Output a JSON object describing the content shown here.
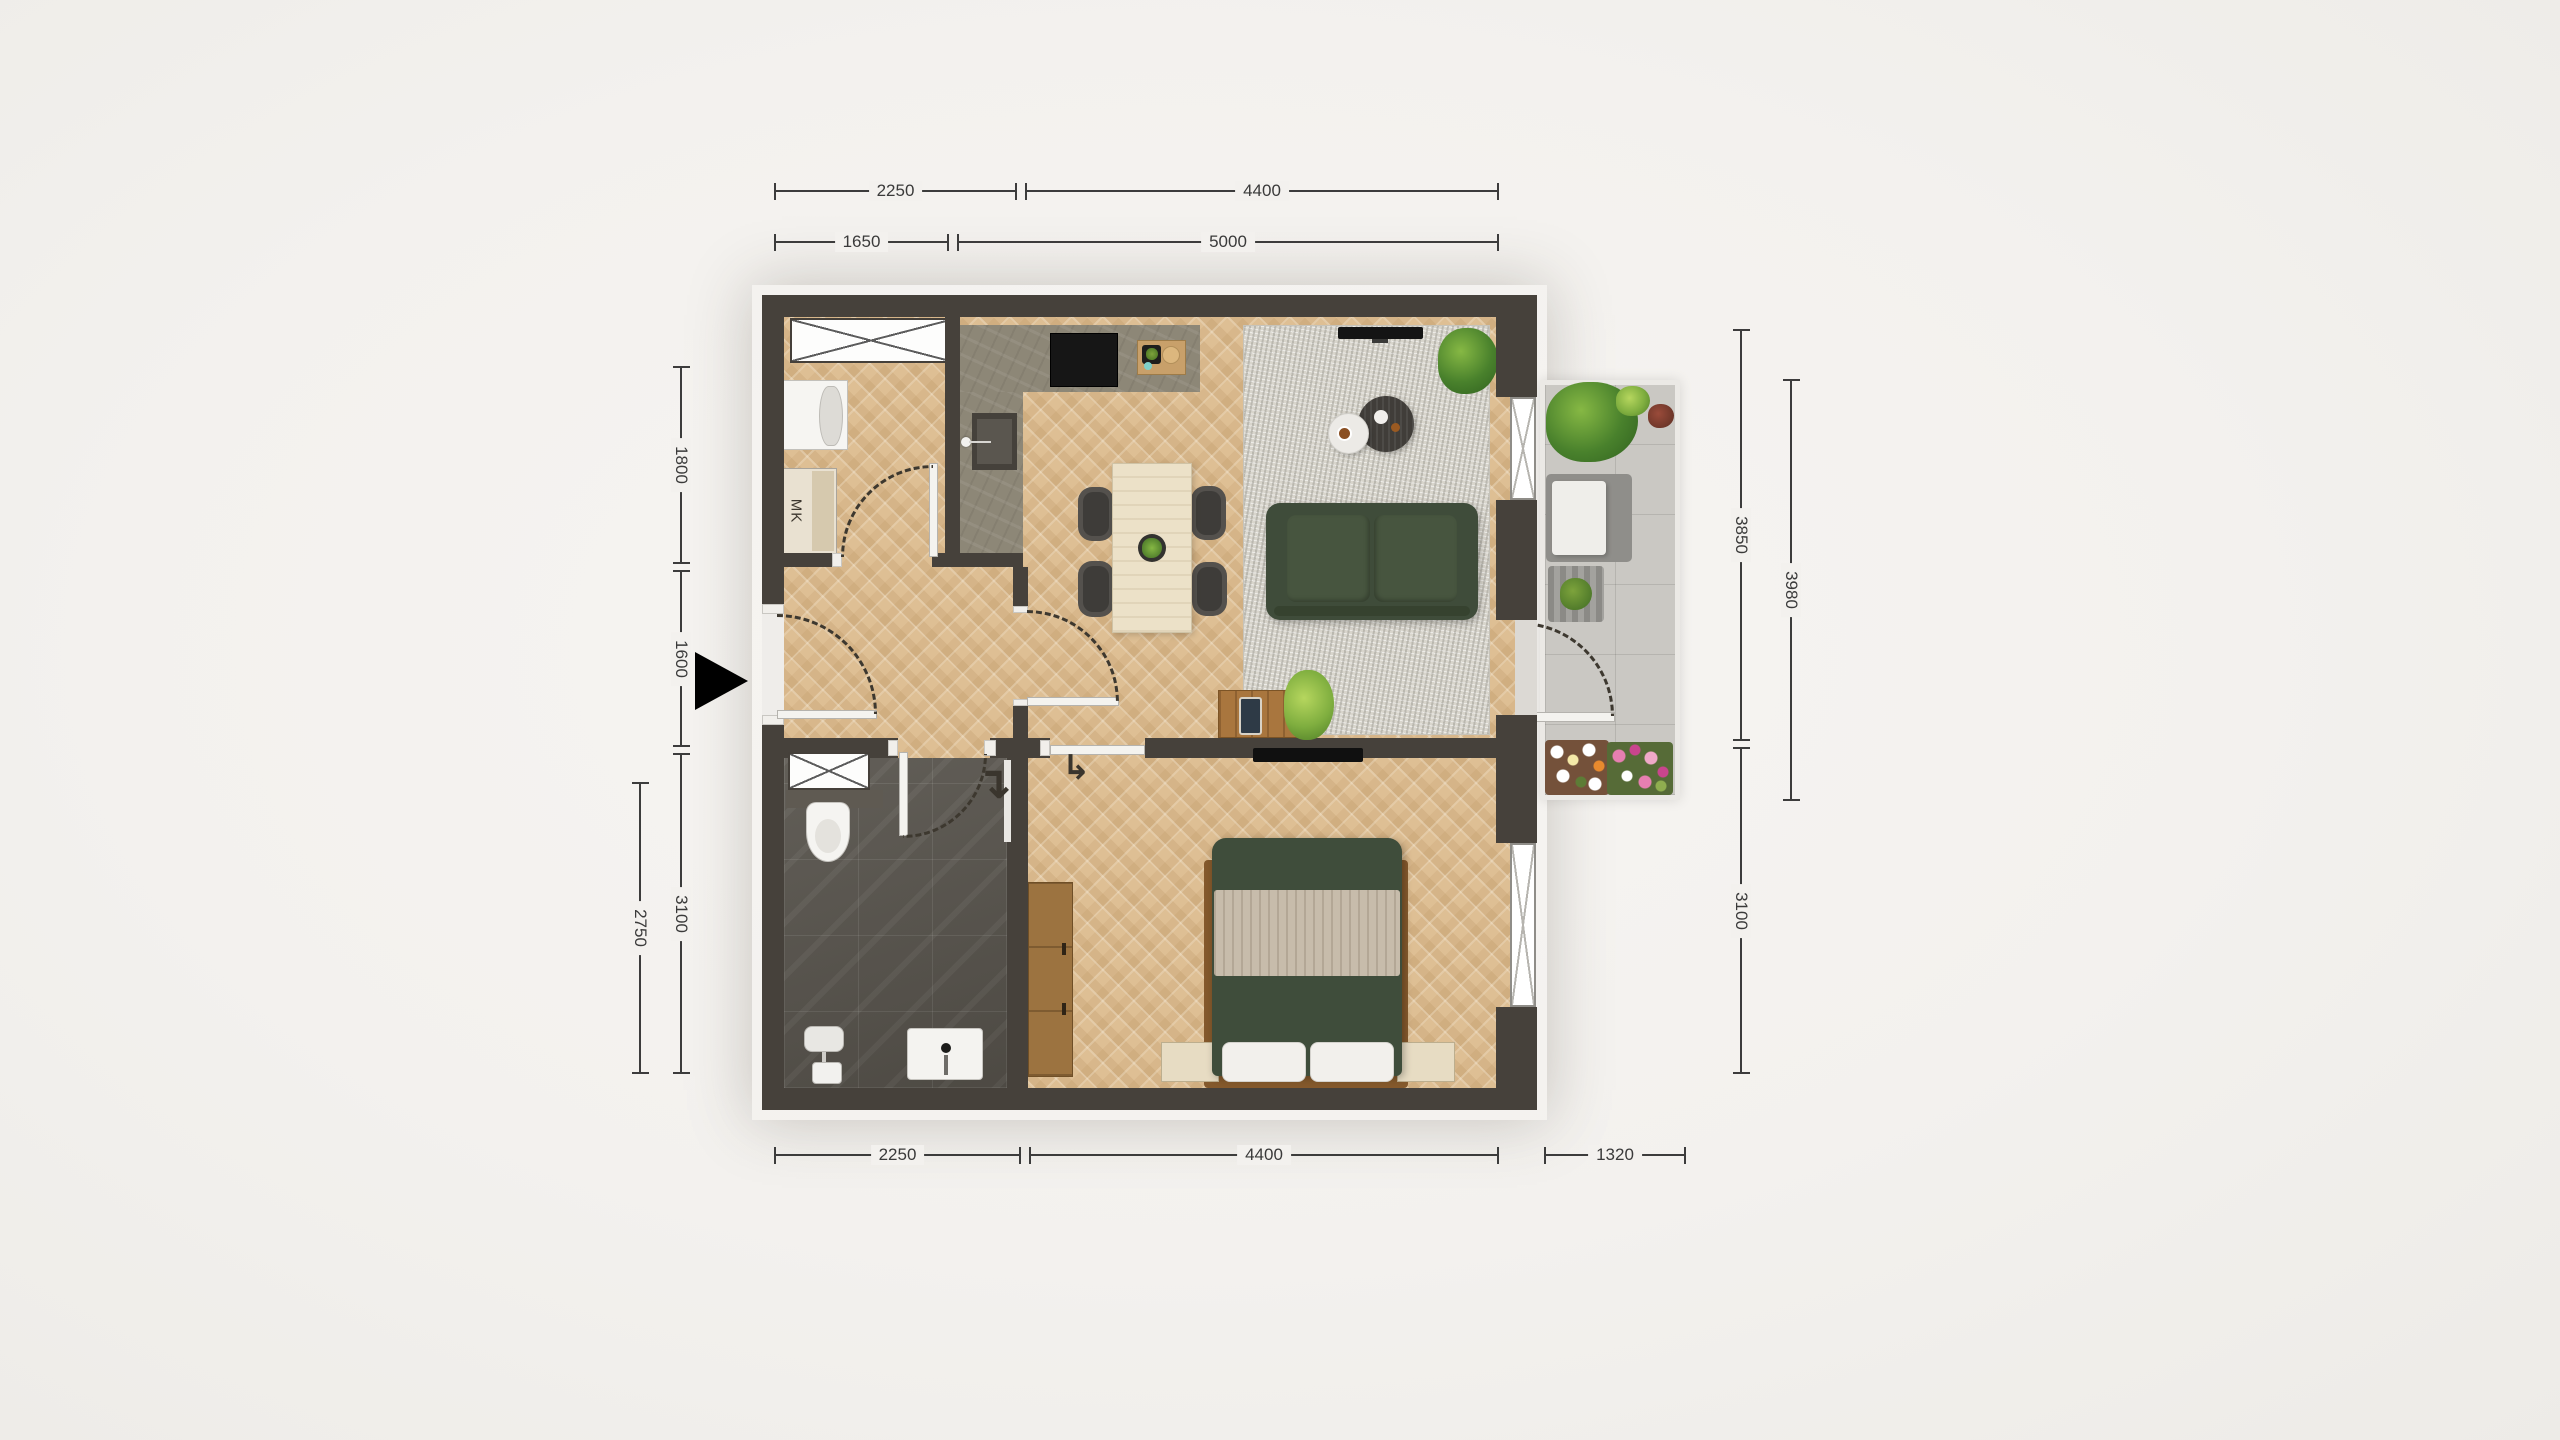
{
  "dims": {
    "top1": [
      "2250",
      "4400"
    ],
    "top2": [
      "1650",
      "5000"
    ],
    "bottom": [
      "2250",
      "4400",
      "1320"
    ],
    "left_inner": [
      "1800",
      "1600",
      "3100"
    ],
    "left_outer": [
      "2750"
    ],
    "right_inner": [
      "3850",
      "3100"
    ],
    "right_outer": [
      "3980"
    ]
  },
  "labels": {
    "meter_cupboard": "MK"
  },
  "icons": {
    "sliding_door_arrow": "↳",
    "bathroom_door_arrow": "↴"
  },
  "colors": {
    "wall": "#46413b",
    "wood_floor": "#debf94",
    "kitchen_floor": "#8d8777",
    "bathroom_floor": "#56524b",
    "balcony_floor": "#cac8c3",
    "rug": "#d8d5cc",
    "sofa_green": "#3f4c3a",
    "bed_green": "#3f4d3b",
    "furniture_wood": "#a9763e",
    "background": "#f3f1ee"
  }
}
